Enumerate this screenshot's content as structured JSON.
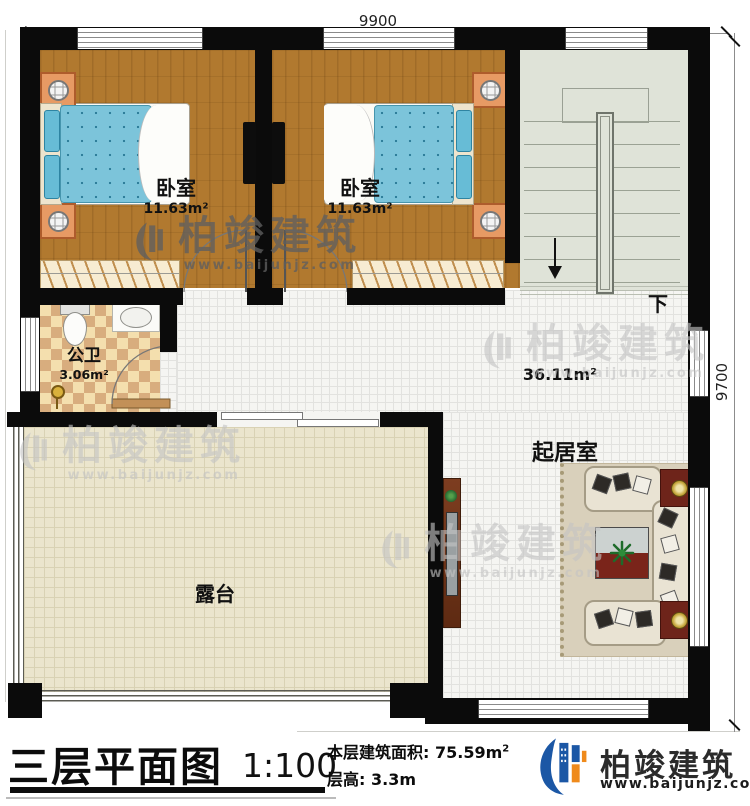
{
  "dimensions": {
    "top": "9900",
    "right": "9700"
  },
  "rooms": {
    "bedroom1": {
      "name": "卧室",
      "area": "11.63m²"
    },
    "bedroom2": {
      "name": "卧室",
      "area": "11.63m²"
    },
    "bathroom": {
      "name": "公卫",
      "area": "3.06m²"
    },
    "living": {
      "name": "起居室",
      "area": "36.11m²"
    },
    "terrace": {
      "name": "露台"
    },
    "stairs": {
      "down": "下"
    }
  },
  "watermark": {
    "brand": "柏竣建筑",
    "url": "www.baijunjz.com"
  },
  "footer": {
    "title": "三层平面图",
    "scale": "1:100",
    "area_label": "本层建筑面积:",
    "area_value": "75.59m",
    "area_sup": "2",
    "height_label": "层高:",
    "height_value": "3.3m",
    "brand": "柏竣建筑",
    "url": "www.baijunjz.com",
    "brand_color": "#1b57a5",
    "accent_color": "#ef8a1b"
  }
}
